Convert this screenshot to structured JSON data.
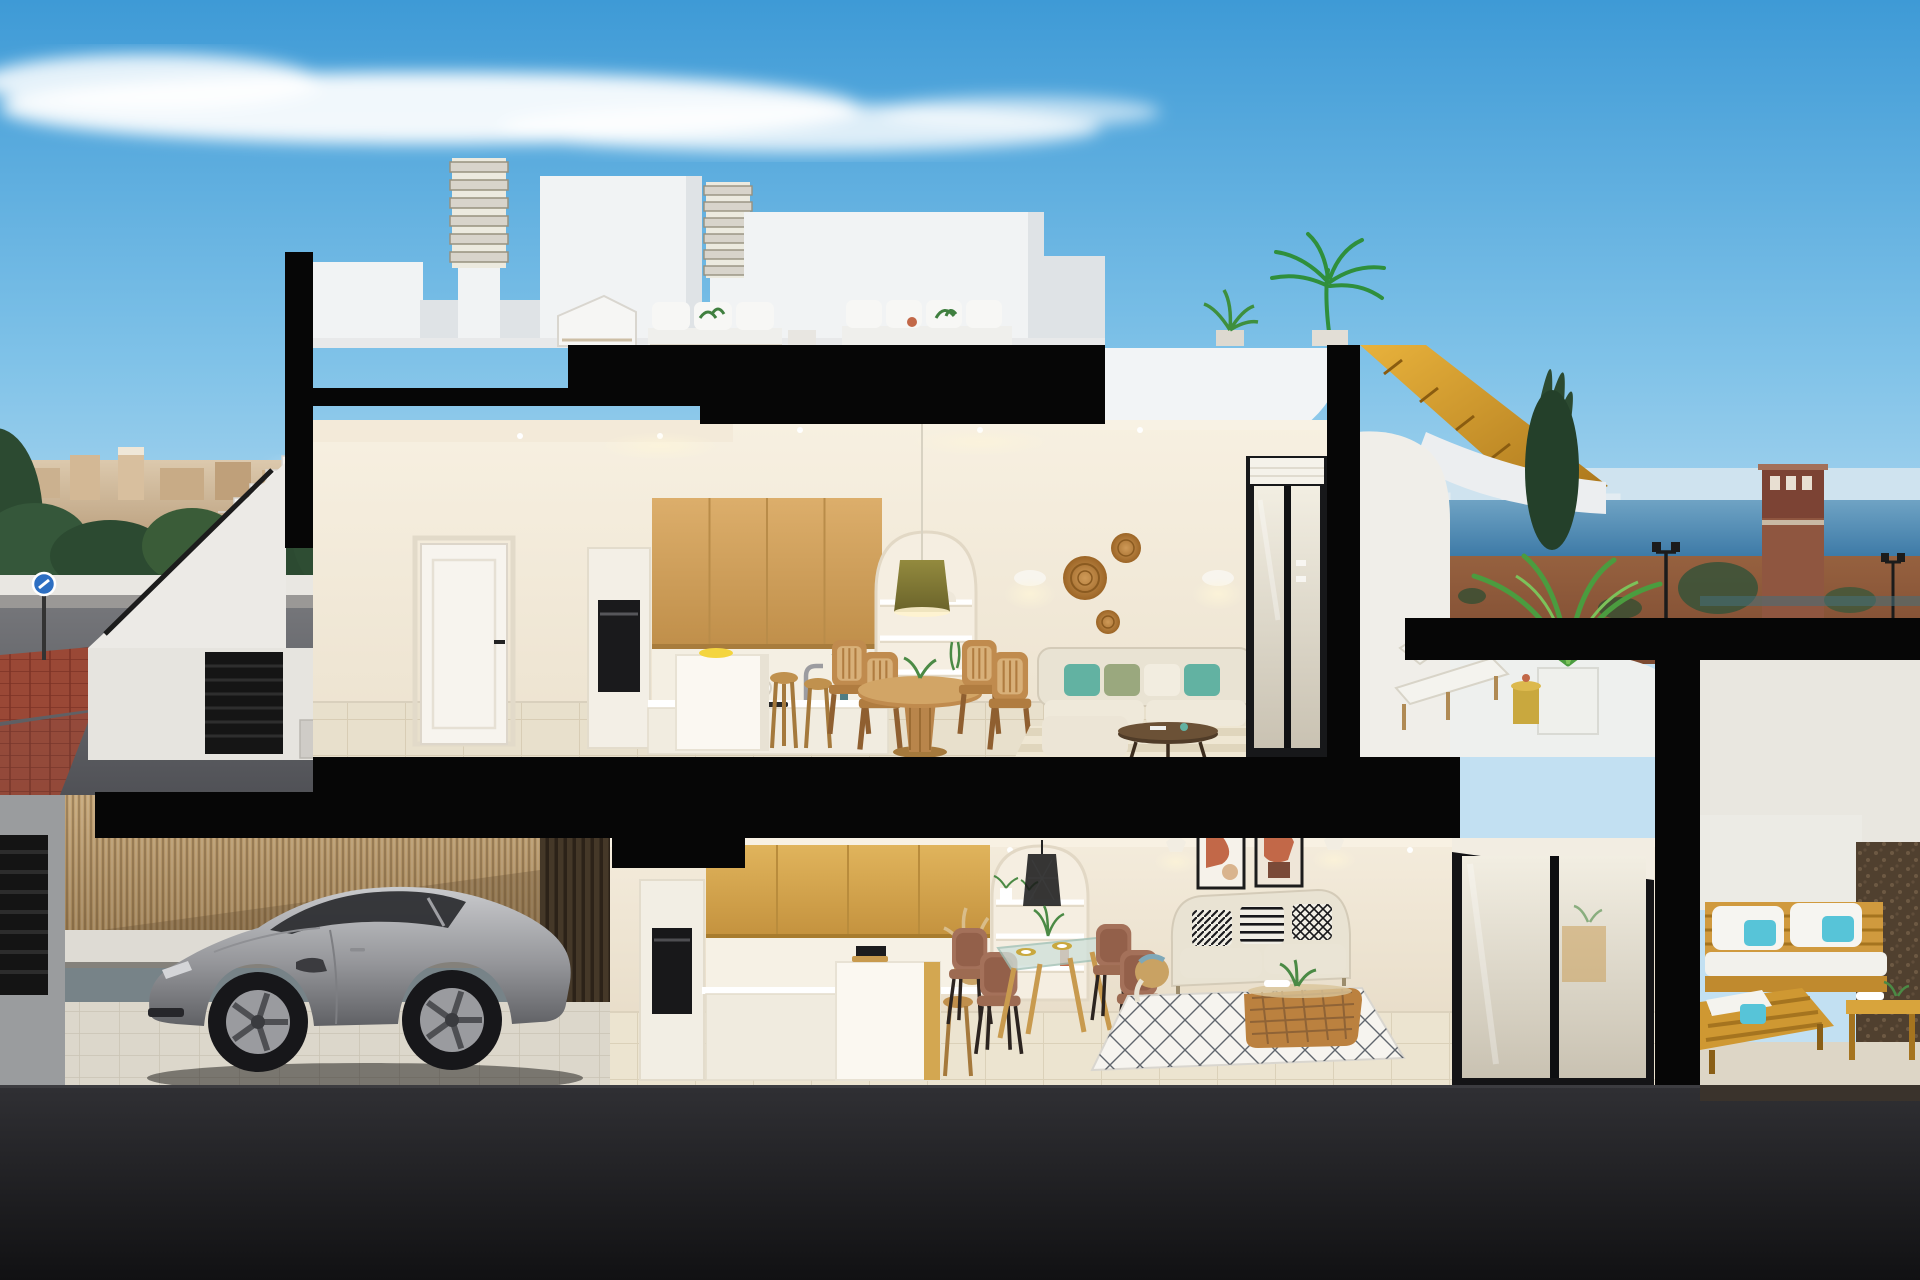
{
  "scene": {
    "type": "architectural-cross-section-render",
    "description": "Photorealistic cutaway 3D render of a modern white two-storey duplex house seen in section under a blue sky: rooftop terrace with two louvered chimneys, upper apartment with kitchen, dining and living room opening to a terrace with a wooden stair to the roof, lower apartment with kitchen, glass dining table, beige sofa and outdoor wooden lounge terrace, and a street-level garage with a silver sports coupe behind a reed fence.",
    "labels": {
      "sky": "Blue sky with wispy clouds",
      "building": "Sectioned duplex house with black cut planes",
      "rooftop": "Roof terrace with chimneys, stair bulkhead, outdoor sofas and potted palms",
      "upper_floor": "Upper apartment: kitchen, dining area, living room",
      "kitchen_upper": "Upper kitchen with oak wall cabinets, built-in oven, white island and two wooden stools",
      "dining_upper": "Round wooden pedestal dining table with four cane chairs under an olive pendant lamp",
      "living_upper": "Cream sofa with teal cushions, dark coffee table, striped rug, rattan wall plates and sconces",
      "upper_terrace": "Upper terrace with sun lounger, gold side table, potted areca palm and curved parapet",
      "wooden_roof_stair": "Golden timber staircase sweeping up to the roof terrace",
      "sliding_door_upper": "Dark-framed sliding glass door with roller blind",
      "lower_floor": "Lower apartment: kitchen, dining corner, living room",
      "kitchen_lower": "Lower kitchen with oak cabinets, black oven, coffee machine, island and pampas basket",
      "dining_lower": "Glass dining table on timber legs with four brown chairs and gold place settings",
      "living_lower": "Beige sofa with black-and-white patterned cushions, two terracotta art prints, rattan coffee table and diamond-pattern rug",
      "sliding_door_lower": "Black-framed sliding glass door reflecting the terrace",
      "lower_terrace": "Covered terrace with acacia-wood sofa, turquoise pillows and slatted coffee table",
      "garage": "Street-level garage with paved floor behind a reed privacy screen",
      "car": "Silver sports coupe parked in the garage",
      "reed_fence": "Tan reed / bamboo privacy fence",
      "exterior_stairs": "White exterior staircase with black handrail and louvered gate",
      "street_left": "Street with brick-red crosswalk, trees, white boundary wall and distant town",
      "sea_view": "Sea horizon with distant skyline, reddish scrubland and street lamps",
      "watch_tower": "Terracotta watchtower on the right horizon",
      "road": "Dark asphalt road in the foreground"
    },
    "rooftop": {
      "objects": [
        "louvered chimney",
        "louvered chimney",
        "stair bulkhead",
        "white outdoor sofa",
        "sun lounger",
        "second outdoor sofa",
        "potted plant",
        "tall potted palm"
      ]
    },
    "upper_floor": {
      "rooms": [
        "kitchen",
        "dining area",
        "living room",
        "terrace"
      ],
      "objects": [
        "white interior door",
        "built-in black oven",
        "oak wall cabinets",
        "white cooktop counter with pot and faucet",
        "white kitchen island with lemons",
        "two wooden bar stools",
        "arched shelf niche with vases and trailing plant",
        "olive pendant lamp",
        "round wooden dining table",
        "four cane dining chairs",
        "cream corner sofa with teal and sage cushions",
        "dark round coffee table",
        "striped beige rug",
        "three rattan wall plates",
        "two white wall sconces",
        "sliding glass door"
      ]
    },
    "lower_floor": {
      "rooms": [
        "kitchen",
        "dining corner",
        "living room",
        "terrace"
      ],
      "objects": [
        "oak wall cabinets",
        "black built-in oven",
        "coffee machine",
        "white island with oak side",
        "wooden stool",
        "pampas grass basket",
        "arched shelf niche",
        "black wire pendant lamp",
        "glass dining table",
        "four brown chairs",
        "beige sofa",
        "three patterned cushions",
        "two abstract terracotta artworks",
        "rattan coffee table with plant",
        "white diamond rug",
        "sliding glass door"
      ]
    },
    "garage": {
      "objects": [
        "silver sports coupe",
        "reed privacy fence",
        "dark slatted wall",
        "paved floor"
      ]
    },
    "lower_terrace": {
      "objects": [
        "acacia wood sofa with white cushions",
        "turquoise pillows",
        "wood lounge chair",
        "slatted wood coffee table",
        "gravel strip",
        "white planter wall"
      ]
    },
    "background": {
      "left": [
        "distant beige town",
        "green trees",
        "white boundary wall",
        "blue traffic sign",
        "brick-red crosswalk",
        "grey street"
      ],
      "right": [
        "sea with distant skyline",
        "reddish scrubland",
        "dark cypress trees",
        "watchtower",
        "street lamps",
        "glass balustrade"
      ]
    }
  },
  "colors": {
    "sky_top": "#3e9ad6",
    "sky_mid": "#7fc2e8",
    "sky_horizon": "#c2e0f2",
    "cloud": "#ffffff",
    "cut_black": "#060606",
    "wall_white": "#f1f3f4",
    "wall_shade": "#dfe3e6",
    "cream_wall": "#f0e9da",
    "wood_cabinet": "#d2a360",
    "wood_cabinet2": "#d8ab52",
    "wood_furniture": "#c08b4e",
    "wood_stair": "#d89a2a",
    "floor_tile": "#e7dfcb",
    "sofa_cream": "#e9e3d3",
    "cushion_teal": "#62b2a2",
    "cushion_sage": "#9aa87e",
    "rattan": "#bb813f",
    "reed_fence": "#b99a6c",
    "slat_dark": "#453828",
    "car_silver": "#a9aaae",
    "car_dark": "#6f7074",
    "glass_dark": "#2a2b2f",
    "sea": "#4283ae",
    "terrain_red": "#8c573d",
    "tree_dark": "#2c4a31",
    "palm_green": "#4b9c3f",
    "street_grey": "#65666a",
    "crosswalk_red": "#9a4836",
    "road_dark": "#1a1a1d",
    "gold_accent": "#c9a83e",
    "terracotta": "#c26848",
    "sign_blue": "#2d6fc2",
    "pattern_ink": "#17171a"
  }
}
